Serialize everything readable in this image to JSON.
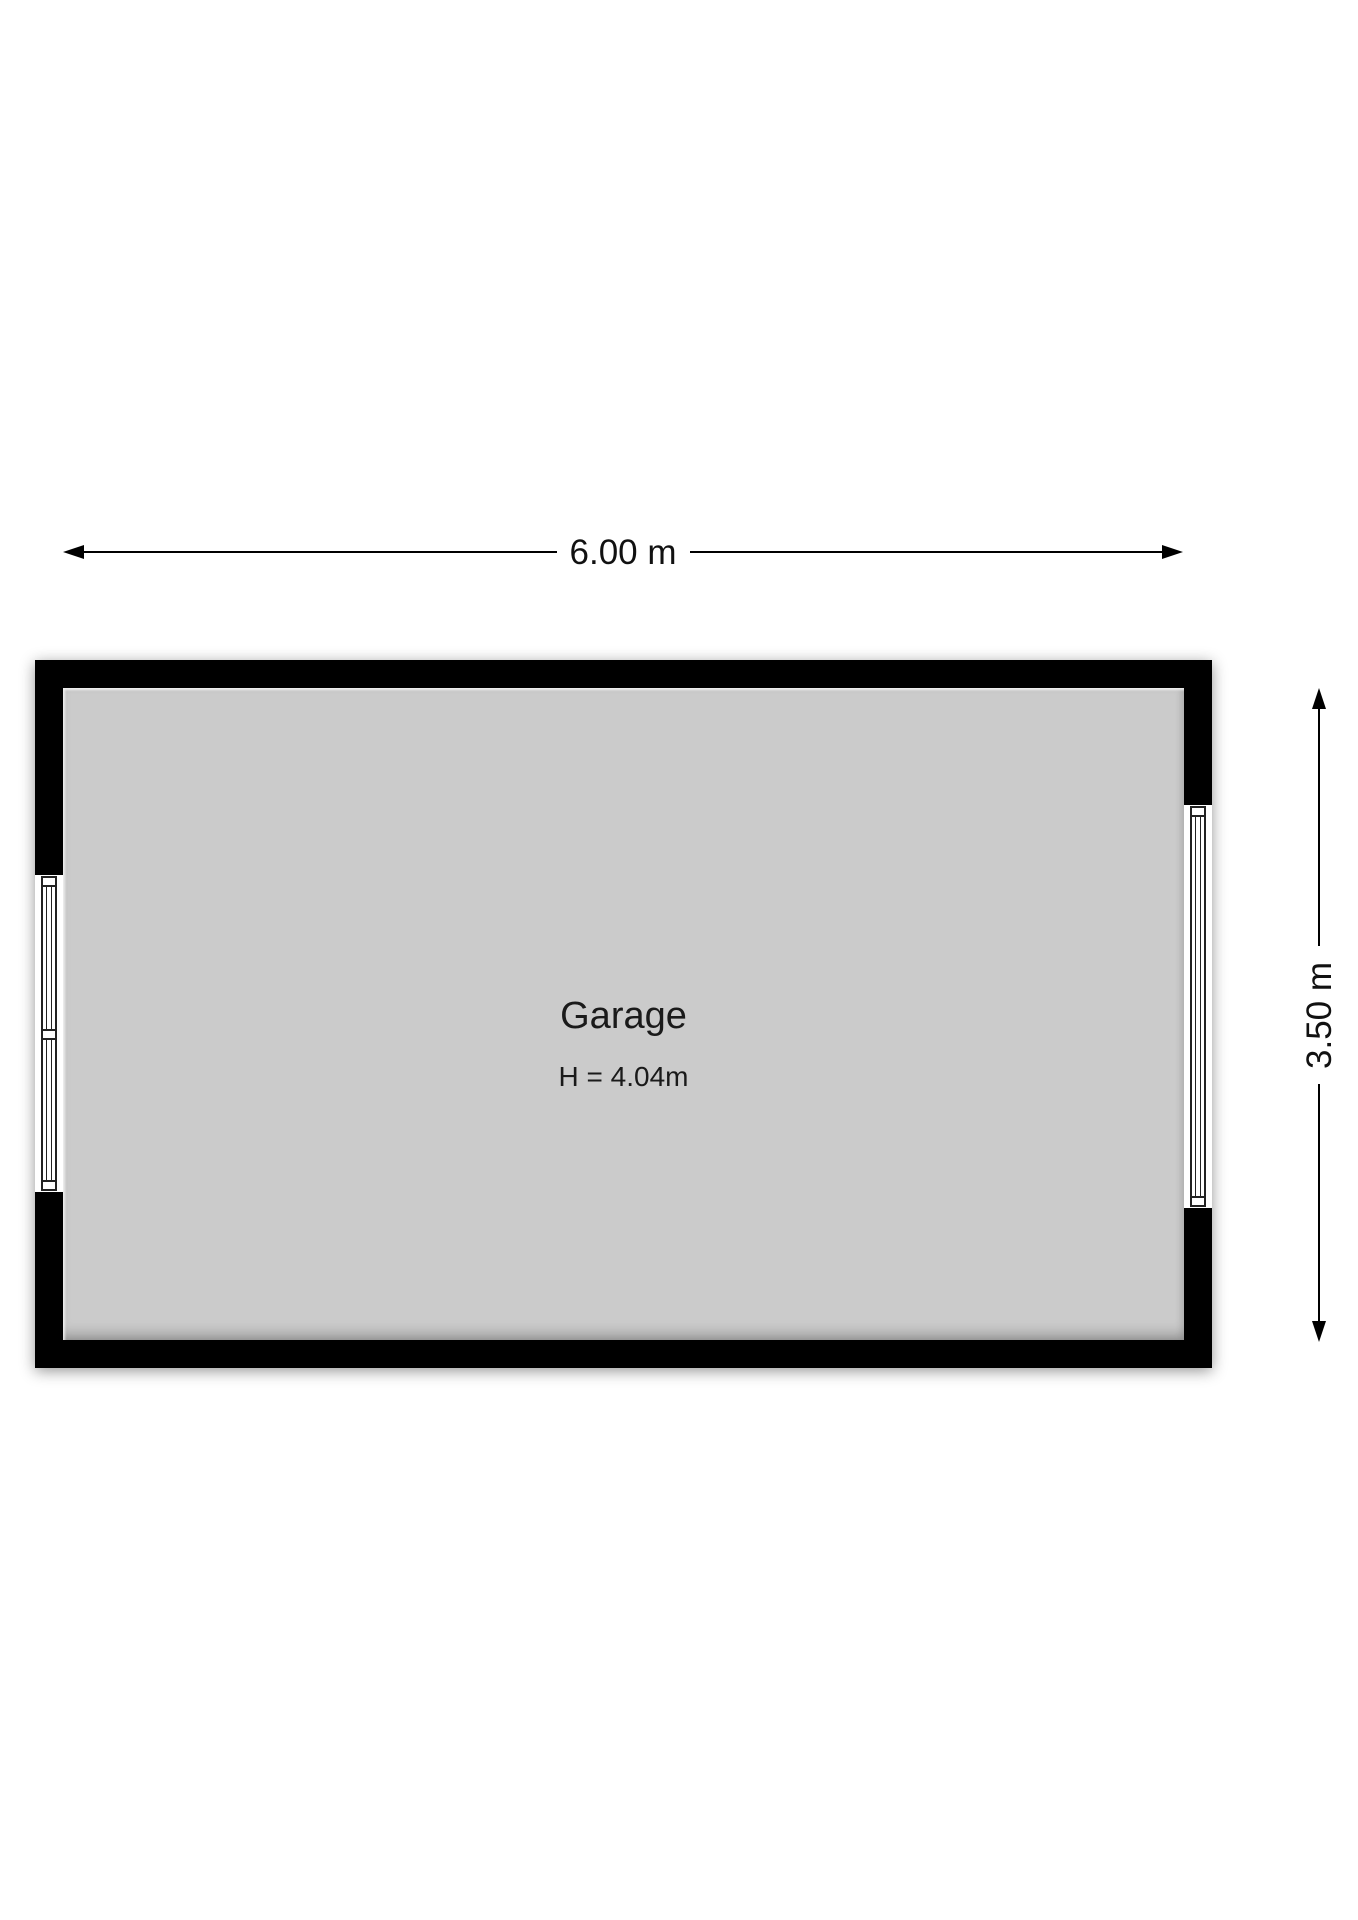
{
  "room": {
    "name": "Garage",
    "ceiling_height_label": "H = 4.04m"
  },
  "dimensions": {
    "width_label": "6.00 m",
    "height_label": "3.50 m"
  },
  "windows": [
    {
      "wall": "left",
      "sections": 2
    },
    {
      "wall": "right",
      "sections": 1
    }
  ],
  "colors": {
    "wall": "#000000",
    "floor": "#cbcbcb",
    "background": "#ffffff",
    "text": "#1a1a1a"
  }
}
